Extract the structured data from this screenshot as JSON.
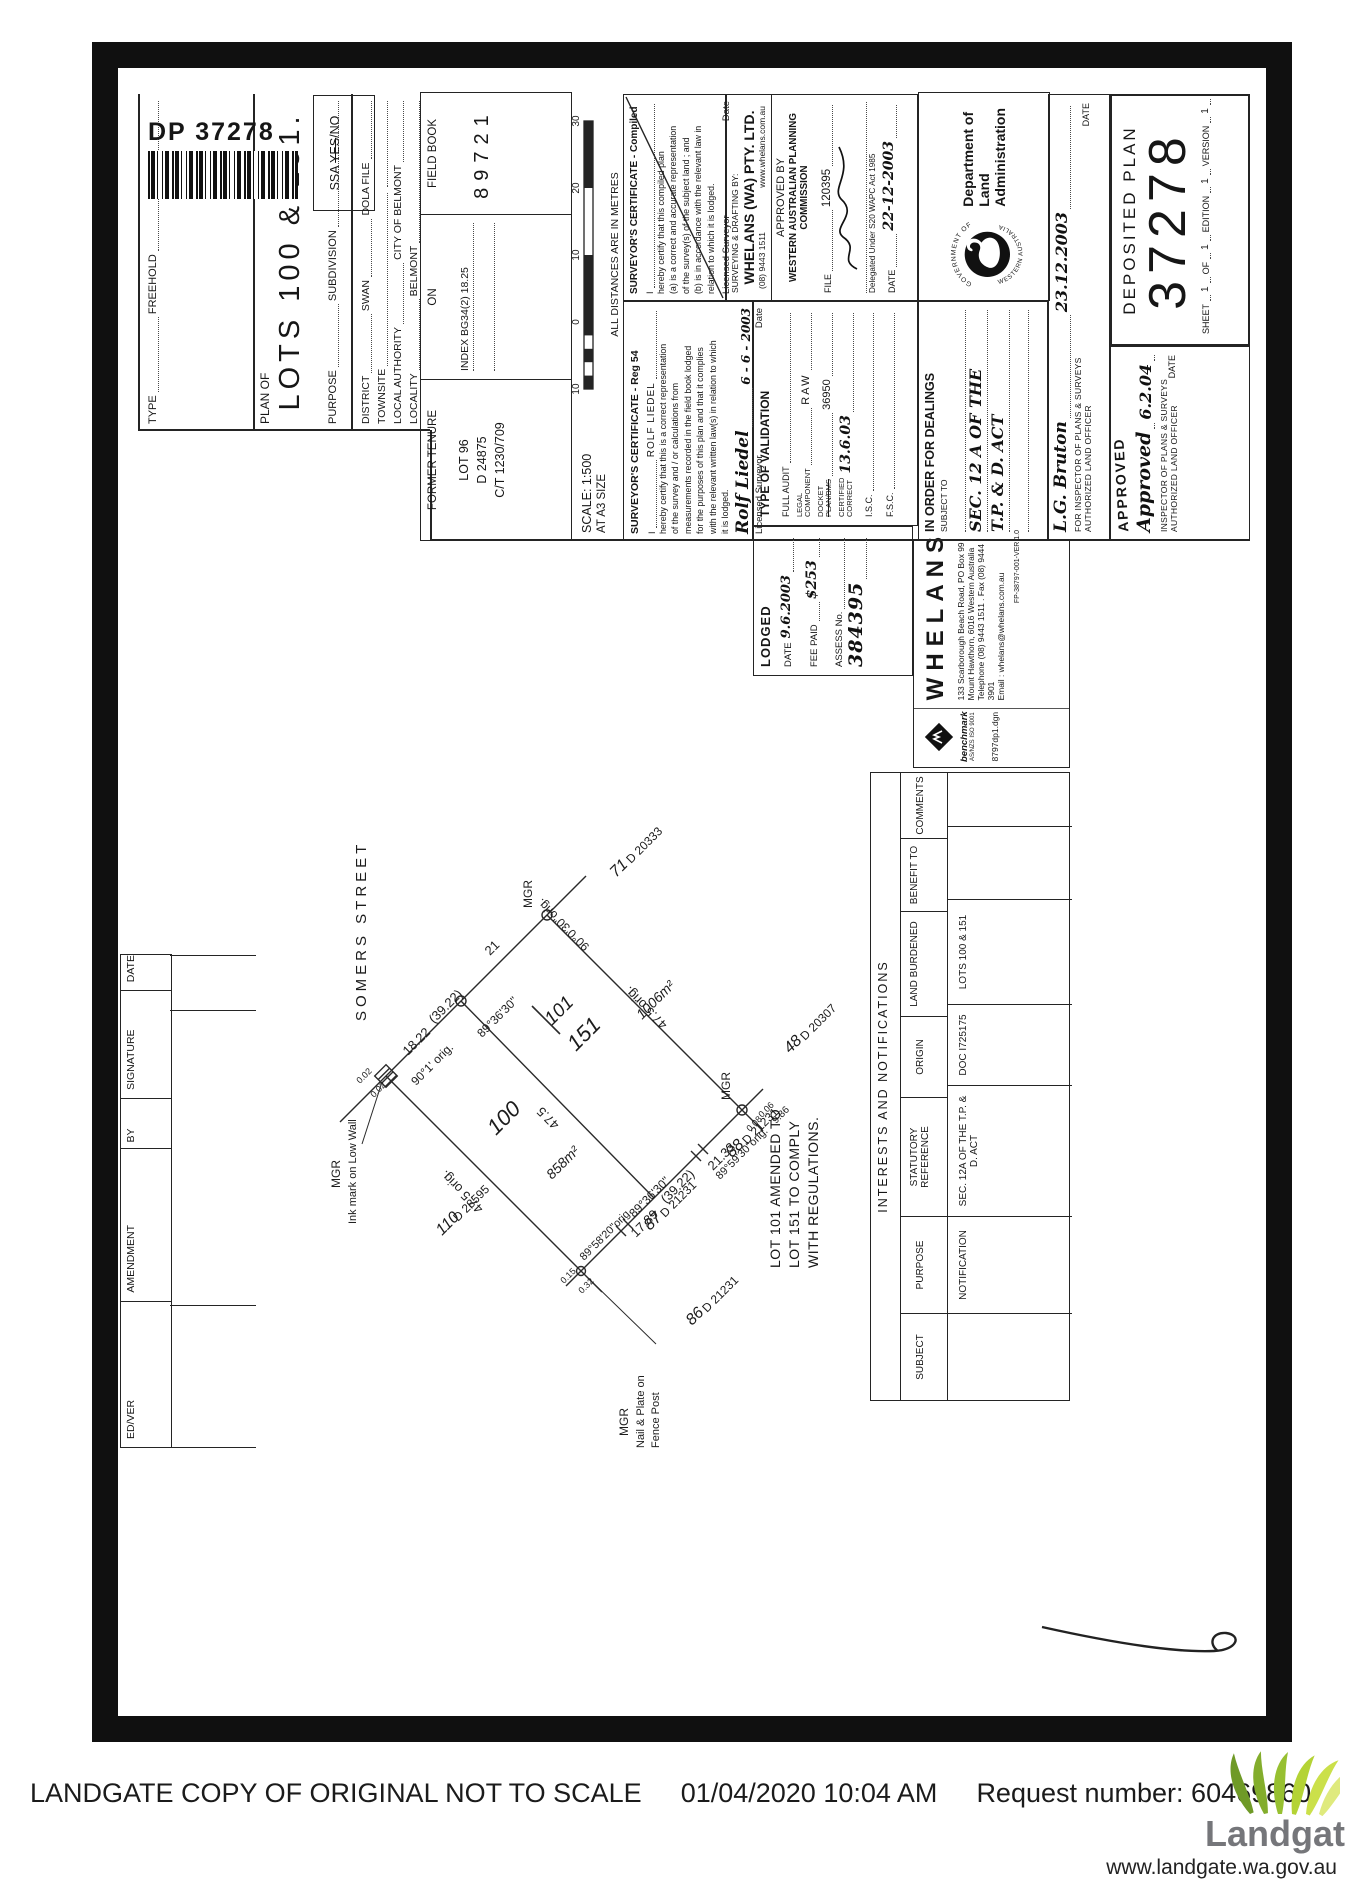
{
  "doc": {
    "dp_label": "DP 37278"
  },
  "ssa": {
    "prefix": "SSA",
    "yes": "YES",
    "slash_no": "/NO"
  },
  "title_block": {
    "type_label": "TYPE",
    "type_value": "FREEHOLD",
    "plan_of_label": "PLAN OF",
    "plan_of_value": "LOTS 100 & 151.",
    "purpose_label": "PURPOSE",
    "purpose_value": "SUBDIVISION",
    "district_label": "DISTRICT",
    "district_value": "SWAN",
    "dola_file_label": "DOLA FILE",
    "townsite_label": "TOWNSITE",
    "local_authority_label": "LOCAL AUTHORITY",
    "local_authority_value": "CITY OF BELMONT",
    "locality_label": "LOCALITY",
    "locality_value": "BELMONT",
    "former_tenure": {
      "header": "FORMER TENURE",
      "lot": "LOT 96",
      "ref": "D 24875",
      "ct": "C/T 1230/709",
      "on_header": "ON",
      "index": "INDEX  BG34(2) 18.25",
      "field_book_header": "FIELD BOOK",
      "field_book_value": "89721"
    },
    "scale": {
      "scale_text": "SCALE: 1:500",
      "size_text": "AT A3 SIZE",
      "bar_labels": [
        "10",
        "0",
        "10",
        "20",
        "30"
      ],
      "note": "ALL DISTANCES ARE IN METRES"
    }
  },
  "certificates": {
    "reg54": {
      "title": "SURVEYOR'S CERTIFICATE  -  Reg 54",
      "intro_i": "I",
      "name": "ROLF LIEDEL",
      "lines": [
        "hereby certify that this is a correct representation",
        "of the survey and / or calculations from",
        "measurements recorded in the field book lodged",
        "for the purposes of this plan and that it complies",
        "with the relevant written law(s) in relation to which",
        "it is lodged."
      ],
      "signature": "Rolf Liedel",
      "date": "6 - 6 - 2003",
      "footer_left": "Licensed Surveyor",
      "footer_right": "Date"
    },
    "compiled": {
      "title": "SURVEYOR'S CERTIFICATE  -  Compiled",
      "intro_i": "I",
      "lines": [
        "hereby certify that this compiled plan",
        "(a) is a correct and accurate representation",
        "of the survey(s) of the subject land ; and",
        "(b) is in accordance with the relevant law in",
        "relation to which it is lodged."
      ],
      "footer_left": "Licensed Surveyor",
      "footer_right": "Date"
    }
  },
  "lodged": {
    "header": "LODGED",
    "date_label": "DATE",
    "date_value": "9.6.2003",
    "fee_label": "FEE PAID",
    "fee_value": "$253",
    "assess_label": "ASSESS No.",
    "assess_value": "384395"
  },
  "validation": {
    "header": "TYPE OF VALIDATION",
    "full_audit": "FULL AUDIT",
    "legal_label": "LEGAL",
    "component_label": "COMPONENT",
    "legal_value": "RAW",
    "docket_label": "DOCKET",
    "planbms_label": "PLAN/BMS",
    "docket_value": "36950",
    "certified_l1": "CERTIFIED",
    "certified_l2": "CORRECT",
    "certified_value": "13.6.03",
    "isc_label": "I.S.C.",
    "fsc_label": "F.S.C."
  },
  "wapc": {
    "sd_label": "SURVEYING & DRAFTING BY:",
    "firm": "WHELANS (WA) PTY. LTD.",
    "phone": "(08) 9443 1511",
    "web": "www.whelans.com.au",
    "approved_by": "APPROVED BY",
    "commission": "WESTERN AUSTRALIAN PLANNING COMMISSION",
    "file_label": "FILE",
    "file_value": "120395",
    "delegated": "Delegated Under S20 WAPC Act 1985",
    "date_label": "DATE",
    "date_value": "22-12-2003"
  },
  "dealings": {
    "header": "IN ORDER FOR DEALINGS",
    "subject_to": "SUBJECT TO",
    "hand_line1": "SEC. 12 A OF THE",
    "hand_line2": "T.P. & D. ACT"
  },
  "crest": {
    "top": "GOVERNMENT OF",
    "bottom": "WESTERN AUSTRALIA",
    "dept_line1": "Department of",
    "dept_line2": "Land Administration"
  },
  "approvals": {
    "row1": {
      "signature": "L.G. Bruton",
      "date": "23.12.2003",
      "caption1": "FOR INSPECTOR OF PLANS & SURVEYS",
      "caption2": "AUTHORIZED LAND OFFICER",
      "date_label": "DATE"
    },
    "row2": {
      "stamp": "APPROVED",
      "hand": "Approved",
      "date": "6.2.04",
      "caption1": "INSPECTOR OF PLANS & SURVEYS",
      "caption2": "AUTHORIZED LAND OFFICER",
      "date_label": "DATE"
    }
  },
  "deposited_plan": {
    "title": "DEPOSITED PLAN",
    "number": "37278",
    "sheet_label": "SHEET",
    "sheet_value": "1",
    "of_label": "OF",
    "of_value": "1",
    "edition_label": "EDITION",
    "edition_value": "1",
    "version_label": "VERSION",
    "version_value": "1"
  },
  "whelans": {
    "name": "WHELANS",
    "addr1": "133 Scarborough Beach Road, PO Box 99",
    "addr2": "Mount Hawthorn, 6016 Western Australia",
    "addr3": "Telephone (08) 9443 1511 . Fax (08) 9444 3901",
    "addr4": "Email : whelans@whelans.com.au",
    "ref": "FP-38797-001-VER 1.0",
    "benchmark": "benchmark",
    "benchmark_sub": "AS/NZS ISO 9001",
    "file_name": "8797dp1.dgn"
  },
  "amendments": {
    "headers": [
      "ED/VER",
      "AMENDMENT",
      "BY",
      "SIGNATURE",
      "DATE"
    ]
  },
  "interests": {
    "title": "INTERESTS  AND  NOTIFICATIONS",
    "headers": [
      "SUBJECT",
      "PURPOSE",
      "STATUTORY REFERENCE",
      "ORIGIN",
      "LAND BURDENED",
      "BENEFIT TO",
      "COMMENTS"
    ],
    "row": [
      "",
      "NOTIFICATION",
      "SEC. 12A OF THE T.P. & D. ACT",
      "DOC I725175",
      "LOTS 100 & 151",
      "",
      ""
    ]
  },
  "drawing": {
    "street": "SOMERS    STREET",
    "mgr": "MGR",
    "mgr_w_caption": "Ink mark on Low Wall",
    "mgr_sw_l1": "Nail & Plate on",
    "mgr_sw_l2": "Fence Post",
    "dims": {
      "front_w": "18.22",
      "front_total": "(39.22)",
      "front_e": "21",
      "rear_w": "17.89",
      "rear_total": "(39.22)",
      "rear_e": "21.33",
      "depth_w": "47.5 orig.",
      "depth_mid": "47.5",
      "depth_e": "47.5 orig."
    },
    "angles": {
      "w": "90°1' orig.",
      "v1": "89°36'30\"",
      "e": "90°0'30\"orig.",
      "sw": "89°58'20\"orig",
      "v2": "89°36'30\"",
      "se": "89°59'30\"orig."
    },
    "offsets": {
      "w1": "0.02",
      "w2": "0.02",
      "sw1": "0.15",
      "sw2": "0.32",
      "se1": "0.08",
      "se2": "0.06",
      "se3": "9.86"
    },
    "lot100": {
      "num": "100",
      "area": "858m²"
    },
    "lot151": {
      "num": "151",
      "old": "101",
      "area": "1006m²"
    },
    "n110": {
      "num": "110",
      "ref": "D 28595"
    },
    "n87": {
      "num": "87",
      "ref": "D 21231"
    },
    "n86": {
      "num": "86",
      "ref": "D 21231"
    },
    "n88": {
      "num": "88",
      "ref": "D 21231"
    },
    "n48": {
      "num": "48",
      "ref": "D 20307"
    },
    "n71": {
      "num": "71",
      "ref": "D 20333"
    },
    "note": [
      "LOT 101  AMENDED TO",
      "LOT 151  TO COMPLY",
      "WITH REGULATIONS."
    ]
  },
  "footer": {
    "text1": "LANDGATE COPY OF ORIGINAL NOT TO SCALE",
    "text2": "01/04/2020 10:04 AM",
    "text3": "Request number: 60469860",
    "logo": "Landgate",
    "url": "www.landgate.wa.gov.au"
  }
}
